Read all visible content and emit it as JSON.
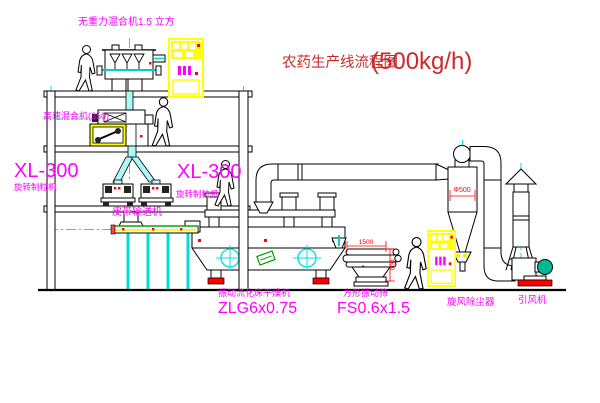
{
  "title": {
    "text": "农药生产线流程图",
    "capacity": "(500kg/h)"
  },
  "equipment_labels": {
    "gravityless_mixer": "无重力混合机1.5 立方",
    "high_speed_mixer": "高速混合机(350)",
    "granulator_left_model": "XL-300",
    "granulator_left_name": "旋转制粒机",
    "granulator_right_model": "XL-300",
    "granulator_right_name": "旋转制粒机",
    "belt_conveyor": "皮带输送机",
    "fluid_bed_dryer_name": "振动流化床干燥机",
    "fluid_bed_dryer_model": "ZLG6x0.75",
    "vibrating_screen_name": "方形振动筛",
    "vibrating_screen_model": "FS0.6x1.5",
    "cyclone_dust_collector": "旋风除尘器",
    "induced_draft_fan": "引风机"
  },
  "dimensions": {
    "screen_length": "1500",
    "screen_width": "600",
    "cyclone_diameter": "Φ500"
  },
  "colors": {
    "label_magenta": "#ff00ff",
    "title_red": "#cc2a2a",
    "dimension_red": "#ff0000",
    "pipe_cyan": "#00e0e0",
    "cabinet_yellow": "#ffff00",
    "belt_green": "#00aa00",
    "motor_teal": "#00b894",
    "line_black": "#000000"
  }
}
